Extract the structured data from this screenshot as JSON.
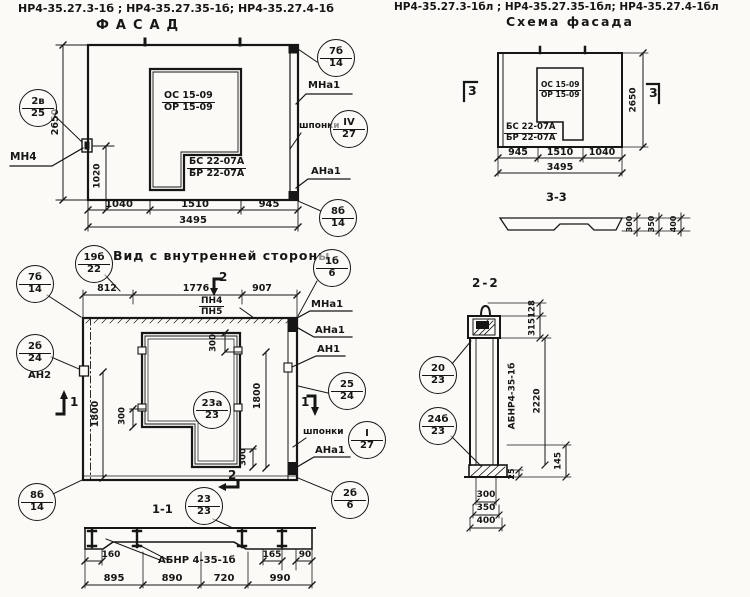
{
  "titles": {
    "codes_left": "НР4-35.27.3-1б ;  НР4-35.27.35-1б;  НР4-35.27.4-1б",
    "facade": "ФАСАД",
    "codes_right": "НР4-35.27.3-1бл ;  НР4-35.27.35-1бл;  НР4-35.27.4-1бл",
    "schema": "Схема фасада",
    "inner_view": "Вид с внутренней стороны",
    "s11": "1-1",
    "s22": "2-2",
    "s33": "3-3"
  },
  "facade": {
    "c_left": {
      "top": "2в",
      "bottom": "25"
    },
    "c_tr": {
      "top": "7б",
      "bottom": "14"
    },
    "c_sh": {
      "top": "IV",
      "bottom": "27"
    },
    "c_br": {
      "top": "8б",
      "bottom": "14"
    },
    "mn4": "МН4",
    "mna1": "МНа1",
    "ana1": "АНа1",
    "shponki": "шпонки",
    "window": {
      "top": "ОС 15-09",
      "bottom": "ОР 15-09"
    },
    "door": {
      "top": "БС 22-07А",
      "bottom": "БР 22-07А"
    },
    "dim_height": "2650",
    "dim_1020": "1020",
    "dim_b": [
      "1040",
      "1510",
      "945"
    ],
    "dim_total": "3495"
  },
  "inner": {
    "c_tl": {
      "top": "19б",
      "bottom": "22"
    },
    "c_l1": {
      "top": "7б",
      "bottom": "14"
    },
    "c_l2": {
      "top": "2б",
      "bottom": "24"
    },
    "c_bl": {
      "top": "8б",
      "bottom": "14"
    },
    "c_tr": {
      "top": "1б",
      "bottom": "6"
    },
    "c_r": {
      "top": "25",
      "bottom": "24"
    },
    "c_sh": {
      "top": "I",
      "bottom": "27"
    },
    "c_br": {
      "top": "2б",
      "bottom": "6"
    },
    "c_mid": {
      "top": "23а",
      "bottom": "23"
    },
    "an2": "АН2",
    "mna1": "МНа1",
    "ana1": "АНа1",
    "an1": "АН1",
    "shponki": "шпонки",
    "ana1b": "АНа1",
    "pn": {
      "top": "ПН4",
      "bottom": "ПН5"
    },
    "dim_t": [
      "812",
      "1776",
      "907"
    ],
    "dim_1800l": "1800",
    "dim_1800r": "1800",
    "dim_300a": "300",
    "dim_300b": "300",
    "dim_300c": "300",
    "m1l": "1",
    "m1r": "1",
    "m2t": "2",
    "m2b": "2"
  },
  "s11": {
    "c": {
      "top": "23",
      "bottom": "23"
    },
    "label": "АБНР 4-35-1б",
    "d160": "160",
    "d165": "165",
    "d90": "90",
    "dims": [
      "895",
      "890",
      "720",
      "990"
    ]
  },
  "schema": {
    "window": {
      "top": "ОС 15-09",
      "bottom": "ОР 15-09"
    },
    "door": {
      "top": "БС 22-07А",
      "bottom": "БР 22-07А"
    },
    "dim_height": "2650",
    "dims": [
      "945",
      "1510",
      "1040"
    ],
    "total": "3495",
    "m3": "3",
    "s33": [
      "300",
      "350",
      "400"
    ]
  },
  "s22": {
    "label": "АБНР4-35-1б",
    "d128": "128",
    "d315": "315",
    "d2220": "2220",
    "d145": "145",
    "d25": "25",
    "c1": {
      "top": "20",
      "bottom": "23"
    },
    "c2": {
      "top": "24б",
      "bottom": "23"
    },
    "dims": [
      "300",
      "350",
      "400"
    ]
  }
}
